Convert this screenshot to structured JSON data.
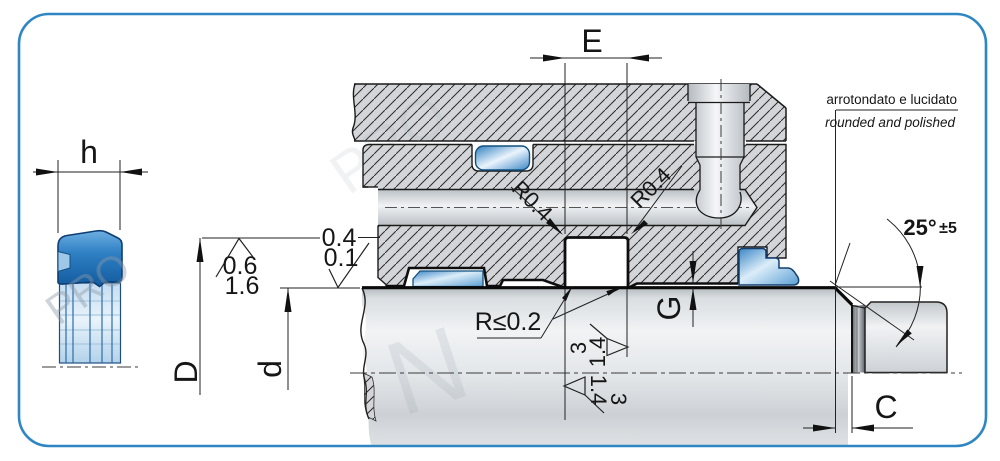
{
  "figure": {
    "type": "technical-seal-installation-drawing",
    "watermark": {
      "text": "PRO",
      "text2": "N"
    },
    "left_view": {
      "height_label": "h"
    },
    "dims": {
      "e": "E",
      "d_outer": "D",
      "d_inner": "d",
      "g": "G",
      "c": "C"
    },
    "radii": {
      "groove_left": "R0.4",
      "groove_right": "R0.4",
      "groove_bottom": "R≤0.2"
    },
    "finish": {
      "rod": [
        "0.4",
        "0.1"
      ],
      "bore": [
        "0.6",
        "1.6"
      ],
      "wall_right": [
        "3",
        "1.4"
      ],
      "wall_left": [
        "1.4",
        "3"
      ]
    },
    "angle": {
      "value": "25°",
      "tolerance": "±5"
    },
    "note": {
      "it": "arrotondato e lucidato",
      "en": "rounded and polished"
    },
    "colors": {
      "frame_border": "#2e86c3",
      "seal_blue_dark": "#1a67ad",
      "seal_blue_light": "#bcd9f0",
      "hatch_fill": "#d3d5d8",
      "line": "#1a1a1a"
    }
  }
}
